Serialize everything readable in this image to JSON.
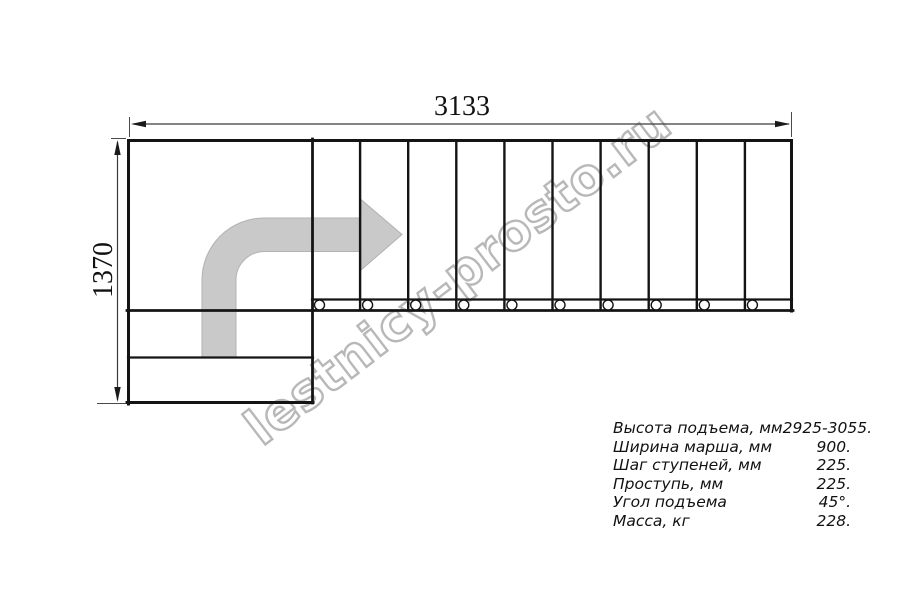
{
  "drawing": {
    "dim_width": {
      "label": "3133"
    },
    "dim_height": {
      "label": "1370"
    },
    "watermark": "lestnicy-prosto.ru",
    "direction_arrow": "quarter-turn-up-then-right",
    "straight_run": {
      "cells": 10,
      "x_start": 312,
      "x_end": 793,
      "top_y": 139,
      "band_top_y": 299,
      "band_bottom_y": 311,
      "baluster_cy": 305,
      "baluster_r": 5,
      "baluster_offset": 7.5
    },
    "bottom_steps": 2,
    "colors": {
      "line": "#141414",
      "dim_line": "#3a3a3a",
      "arrow_fill": "#c9c9c9",
      "watermark": "#b8b8b8",
      "text": "#111111",
      "background": "#ffffff"
    }
  },
  "specs": {
    "rows": [
      {
        "label": "Высота подъема, мм",
        "value": "2925-3055."
      },
      {
        "label": "Ширина марша, мм",
        "value": "900."
      },
      {
        "label": "Шаг ступеней, мм",
        "value": "225."
      },
      {
        "label": "Проступь, мм",
        "value": "225."
      },
      {
        "label": "Угол подъема",
        "value": "45°."
      },
      {
        "label": "Масса, кг",
        "value": "228."
      }
    ]
  }
}
